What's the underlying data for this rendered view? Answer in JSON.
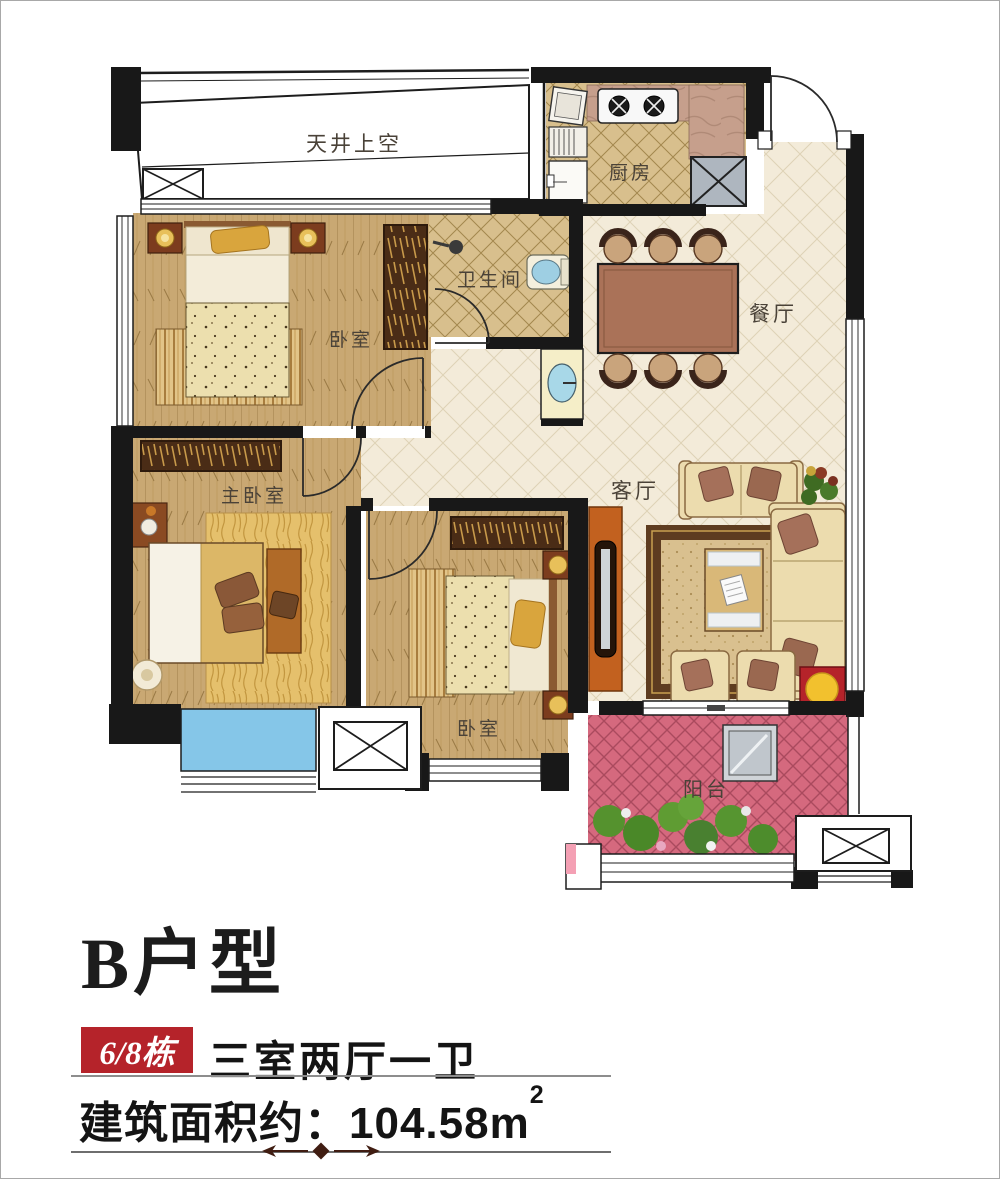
{
  "plan": {
    "rooms": {
      "light_well": {
        "label": "天井上空"
      },
      "kitchen": {
        "label": "厨房"
      },
      "bathroom": {
        "label": "卫生间"
      },
      "dining": {
        "label": "餐厅"
      },
      "living": {
        "label": "客厅"
      },
      "bedroom_top": {
        "label": "卧室"
      },
      "bedroom_bottom": {
        "label": "卧室"
      },
      "master_bedroom": {
        "label": "主卧室"
      },
      "balcony": {
        "label": "阳台"
      }
    },
    "colors": {
      "wall_black": "#181818",
      "wood_floor": "#c9a873",
      "tile_tan": "#d8bf8d",
      "hall_cream": "#f3ebd9",
      "balcony_pink": "#d5697e",
      "bay_window_blue": "#85c6e8",
      "duct_gray": "#aeb6bf"
    }
  },
  "info": {
    "title": "B户型",
    "building_badge": "6/8栋",
    "layout": "三室两厅一卫",
    "area_label": "建筑面积约：",
    "area_value": "104.58",
    "area_unit": "m",
    "area_exponent": "2",
    "accent_red": "#b5232a"
  }
}
